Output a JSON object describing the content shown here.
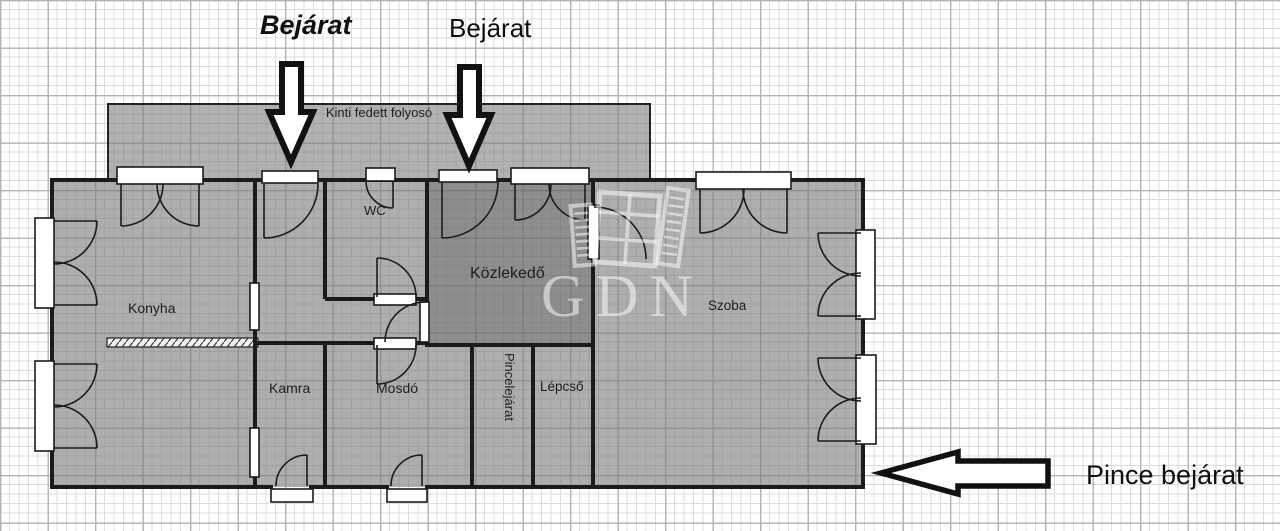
{
  "annotations": {
    "entrance_label_1": "Bejárat",
    "entrance_label_2": "Bejárat",
    "basement_entrance_label": "Pince bejárat"
  },
  "rooms": {
    "corridor": "Kinti fedett folyosó",
    "kitchen": "Konyha",
    "wc": "WC",
    "hallway": "Közlekedő",
    "room": "Szoba",
    "pantry": "Kamra",
    "washroom": "Mosdó",
    "basement_stairs": "Pincelejárat",
    "stairs": "Lépcső"
  },
  "watermark": {
    "text": "GDN"
  },
  "colors": {
    "background": "#ffffff",
    "grid_minor": "#dcdcdc",
    "grid_major": "#b3b3b3",
    "room_fill": "#7d7d7d",
    "hallway_overlay": "#464646",
    "wall": "#1b1b1b",
    "opening_fill": "#ffffff",
    "annotation_text": "#101010"
  }
}
